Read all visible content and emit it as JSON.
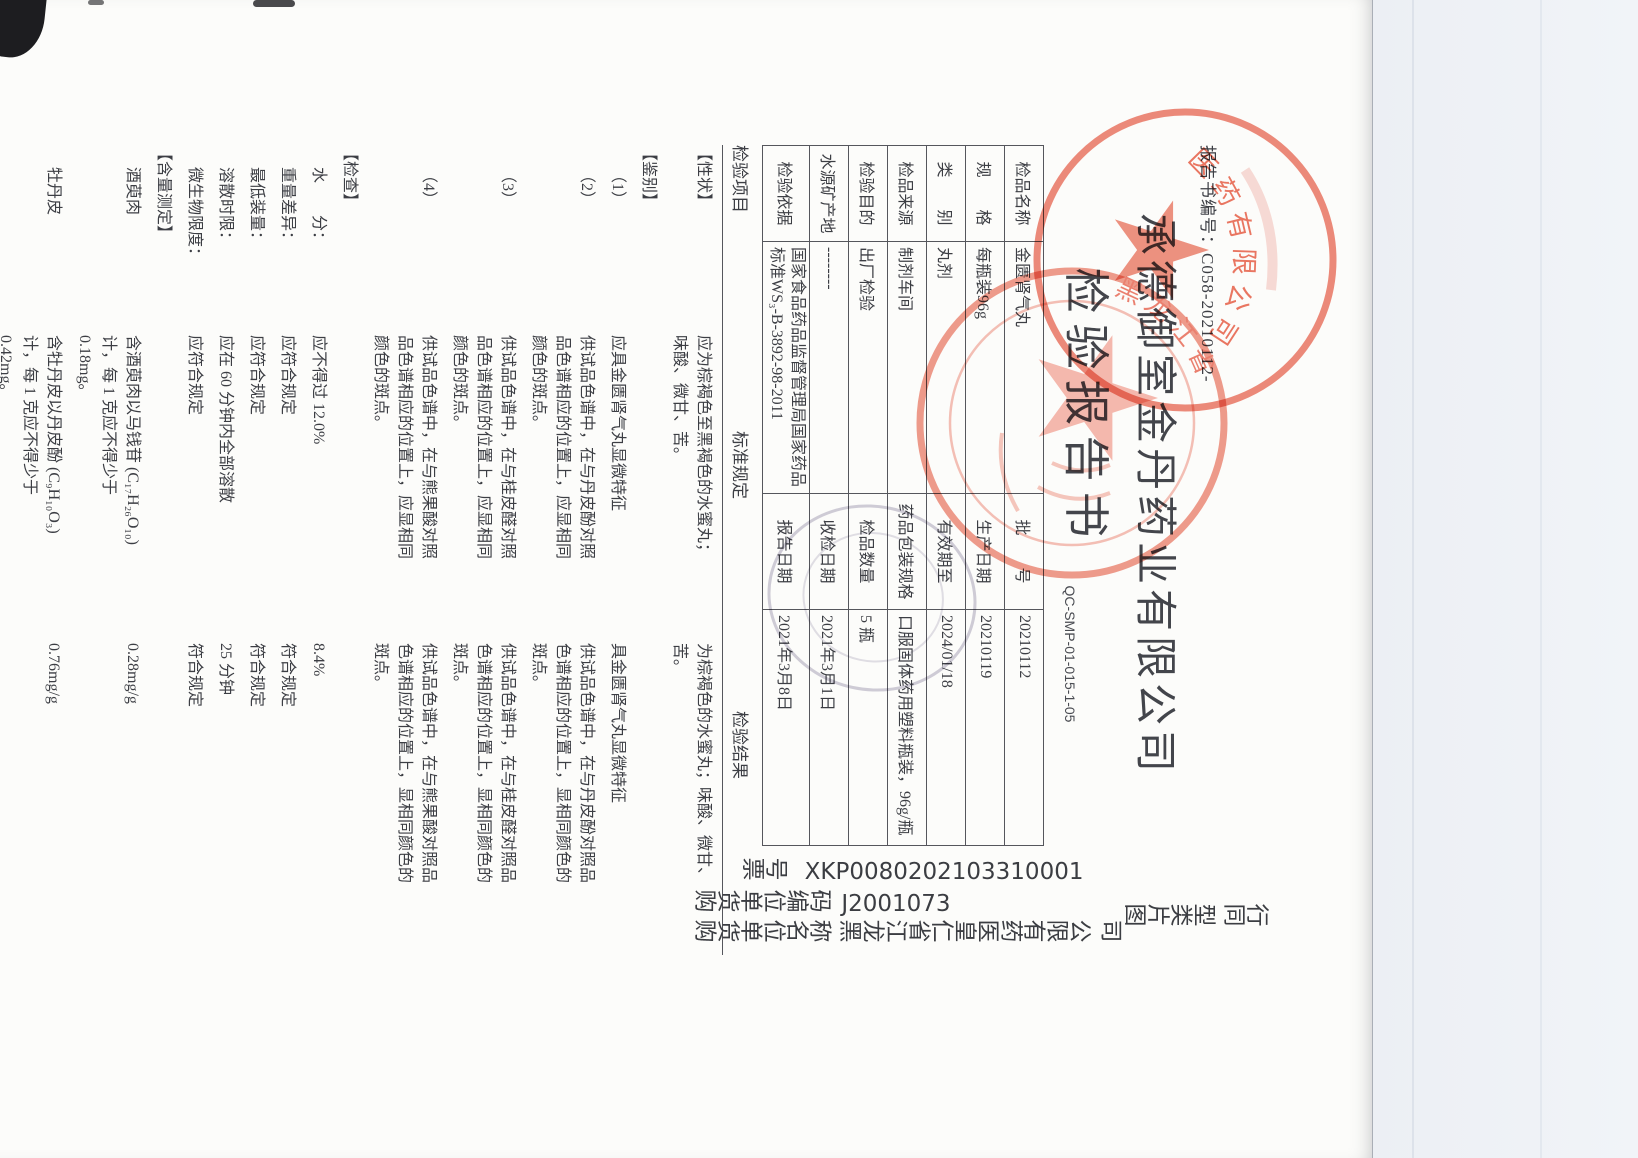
{
  "doc": {
    "report_no_label": "报告书编号：",
    "report_no": "C058-20210112-",
    "company": "承德御室金丹药业有限公司",
    "title": "检验报告书",
    "qc_code": "QC-SMP-01-015-1-05",
    "info": {
      "r1": {
        "l1": "检品名称",
        "v1": "金匮肾气丸",
        "l2": "批　　号",
        "v2": "20210112"
      },
      "r2": {
        "l1": "规　　格",
        "v1": "每瓶装96g",
        "l2": "生产日期",
        "v2": "20210119"
      },
      "r3": {
        "l1": "类　　别",
        "v1": "丸剂",
        "l2": "有效期至",
        "v2": "2024/01/18"
      },
      "r4": {
        "l1": "检品来源",
        "v1": "制剂车间",
        "l2": "药品包装规格",
        "v2": "口服固体药用塑料瓶装，96g/瓶"
      },
      "r5": {
        "l1": "检验目的",
        "v1": "出厂检验",
        "l2": "检品数量",
        "v2": "5 瓶"
      },
      "r6": {
        "l1": "水源矿产地",
        "v1": "--------",
        "l2": "收检日期",
        "v2": "2021年3月1日"
      },
      "r7": {
        "l1": "检验依据",
        "v1": "国家食品药品监督管理局国家药品标准WS₃-B-3892-98-2011",
        "l2": "报告日期",
        "v2": "2021年3月8日"
      }
    },
    "headers": {
      "item": "检验项目",
      "spec": "标准规定",
      "result": "检验结果"
    },
    "rows": [
      {
        "item": "【性状】",
        "spec": "应为棕褐色至黑褐色的水蜜丸；味酸、微甘、苦。",
        "result": "为棕褐色的水蜜丸；味酸、微甘、苦。"
      },
      {
        "item": "【鉴别】",
        "spec": "",
        "result": ""
      },
      {
        "item": "（1）",
        "spec": "应具金匮肾气丸显微特征",
        "result": "具金匮肾气丸显微特征"
      },
      {
        "item": "（2）",
        "spec": "供试品色谱中，在与丹皮酚对照品色谱相应的位置上，应显相同颜色的斑点。",
        "result": "供试品色谱中，在与丹皮酚对照品色谱相应的位置上，显相同颜色的斑点。"
      },
      {
        "item": "（3）",
        "spec": "供试品色谱中，在与桂皮醛对照品色谱相应的位置上，应显相同颜色的斑点。",
        "result": "供试品色谱中，在与桂皮醛对照品色谱相应的位置上，显相同颜色的斑点。"
      },
      {
        "item": "（4）",
        "spec": "供试品色谱中，在与熊果酸对照品色谱相应的位置上，应显相同颜色的斑点。",
        "result": "供试品色谱中，在与熊果酸对照品色谱相应的位置上，显相同颜色的斑点。"
      },
      {
        "item": "【检查】",
        "spec": "",
        "result": ""
      },
      {
        "item": "水　　分：",
        "spec": "应不得过 12.0%",
        "result": "8.4%"
      },
      {
        "item": "重量差异：",
        "spec": "应符合规定",
        "result": "符合规定"
      },
      {
        "item": "最低装量：",
        "spec": "应符合规定",
        "result": "符合规定"
      },
      {
        "item": "溶散时限：",
        "spec": "应在 60 分钟内全部溶散",
        "result": "25 分钟"
      },
      {
        "item": "微生物限度：",
        "spec": "应符合规定",
        "result": "符合规定"
      },
      {
        "item": "【含量测定】",
        "spec": "",
        "result": ""
      },
      {
        "item": "酒萸肉",
        "spec": "含酒萸肉以马钱苷 (C₁₇H₂₆O₁₀) 计，每 1 克应不得少于 0.18mg。",
        "result": "0.28mg/g"
      },
      {
        "item": "牡丹皮",
        "spec": "含牡丹皮以丹皮酚 (C₉H₁₀O₃) 计，每 1 克应不得少于 0.42mg。",
        "result": "0.76mg/g"
      }
    ],
    "conclusion": "结　论：本品按国家食品药品监督管理局国家药品标准 WS₃-B-3892-98-2011 检验，结果符合规定。",
    "signers": {
      "tester": "检验人：",
      "reviewer": "复核人：",
      "approver": "负责人："
    }
  },
  "overlay": {
    "ticket_label": "票号",
    "ticket_value": "XKP0080202103310001",
    "buyer_code_label": "购货单位编码",
    "buyer_code_value": "J2001073",
    "buyer_name_label": "购货单位名称",
    "buyer_name_value": "黑龙江省仁皇医药有限公 司",
    "image_type_label": "图片类型",
    "image_type_value": "同行"
  },
  "stamps": {
    "stamp_a_arc_text": "医药有限公司",
    "stamp_b_arc_text": "黑龙江省",
    "red": "#e4573f"
  }
}
